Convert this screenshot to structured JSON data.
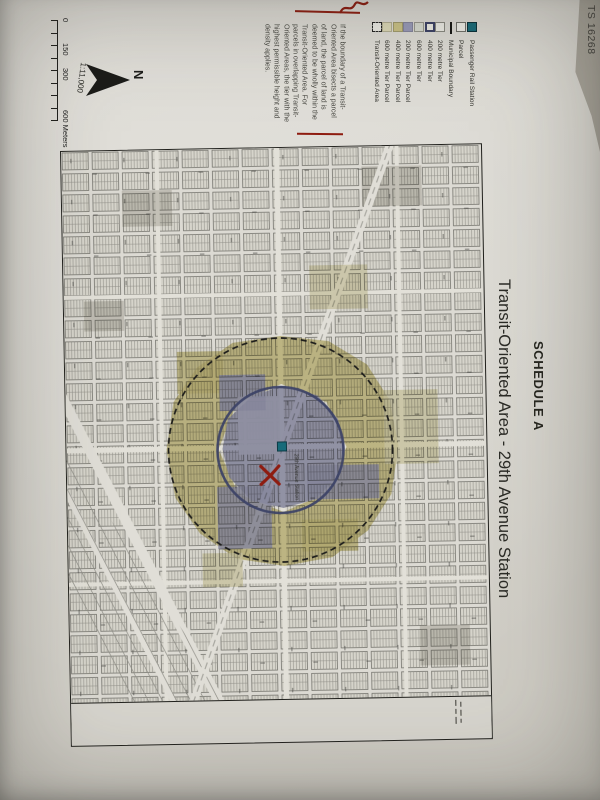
{
  "photo": {
    "stamp": "TS 16268"
  },
  "document": {
    "schedule_label": "SCHEDULE A",
    "title": "Transit-Oriented Area - 29th Avenue Station",
    "north_label": "N",
    "scale": {
      "ratio": "1:11,000",
      "ticks": [
        "0",
        "150",
        "300"
      ],
      "end_label": "600 Meters"
    },
    "note": "If the boundary of a Transit-Oriented Area bisects a parcel of land, the parcel of land is deemed to be wholly within the Transit-Oriented Area. For parcels in overlapping Transit-Oriented Areas, the tier with the highest permissible height and density applies.",
    "legend": [
      {
        "label": "Passenger Rail Station",
        "swatch": "station"
      },
      {
        "label": "Parcel",
        "swatch": "parcel"
      },
      {
        "label": "Municipal Boundary",
        "swatch": "line"
      },
      {
        "label": "200 metre Tier",
        "swatch": "tier200"
      },
      {
        "label": "400 metre Tier",
        "swatch": "tier400"
      },
      {
        "label": "600 metre Tier",
        "swatch": "tier600"
      },
      {
        "label": "200 metre Tier Parcel",
        "swatch": "p200"
      },
      {
        "label": "400 metre Tier Parcel",
        "swatch": "p400"
      },
      {
        "label": "600 metre Tier Parcel",
        "swatch": "p600"
      },
      {
        "label": "Transit-Oriented Area",
        "swatch": "toa"
      }
    ],
    "map": {
      "station_label": "29th Avenue Station"
    }
  },
  "colors": {
    "station_teal": "#176b7a",
    "tier200_parcel": "#9a9cbb",
    "tier400_parcel": "#cdc487",
    "tier600_parcel": "#dfdbb9",
    "tier400_ring": "#3b4166",
    "toa_boundary": "#1d1d1b",
    "annotation_red": "#8e1c10",
    "paper": "#d9d7d0",
    "backdrop": "#aba79d"
  }
}
